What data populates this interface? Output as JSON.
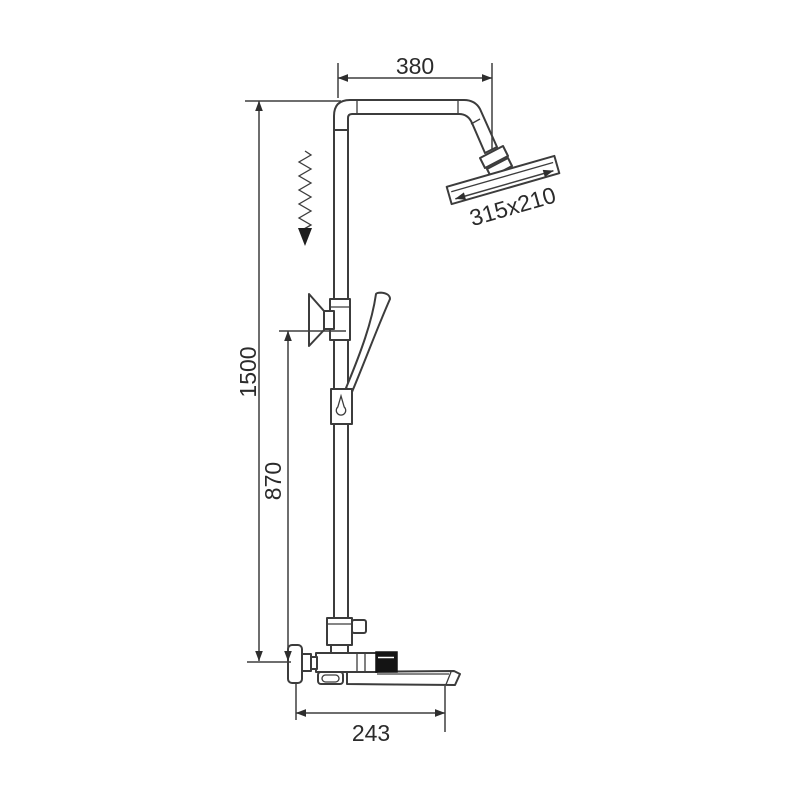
{
  "diagram": {
    "type": "technical-dimension-drawing",
    "subject": "wall-mounted shower column with rain head, hand shower and tub spout mixer",
    "dimensions": {
      "top_arm_width": "380",
      "overall_height": "1500",
      "bracket_height": "870",
      "spout_depth": "243",
      "head_size": "315x210"
    },
    "colors": {
      "line": "#3c3c3c",
      "text": "#2b2b2b",
      "knob": "#141414",
      "background": "#ffffff"
    }
  }
}
